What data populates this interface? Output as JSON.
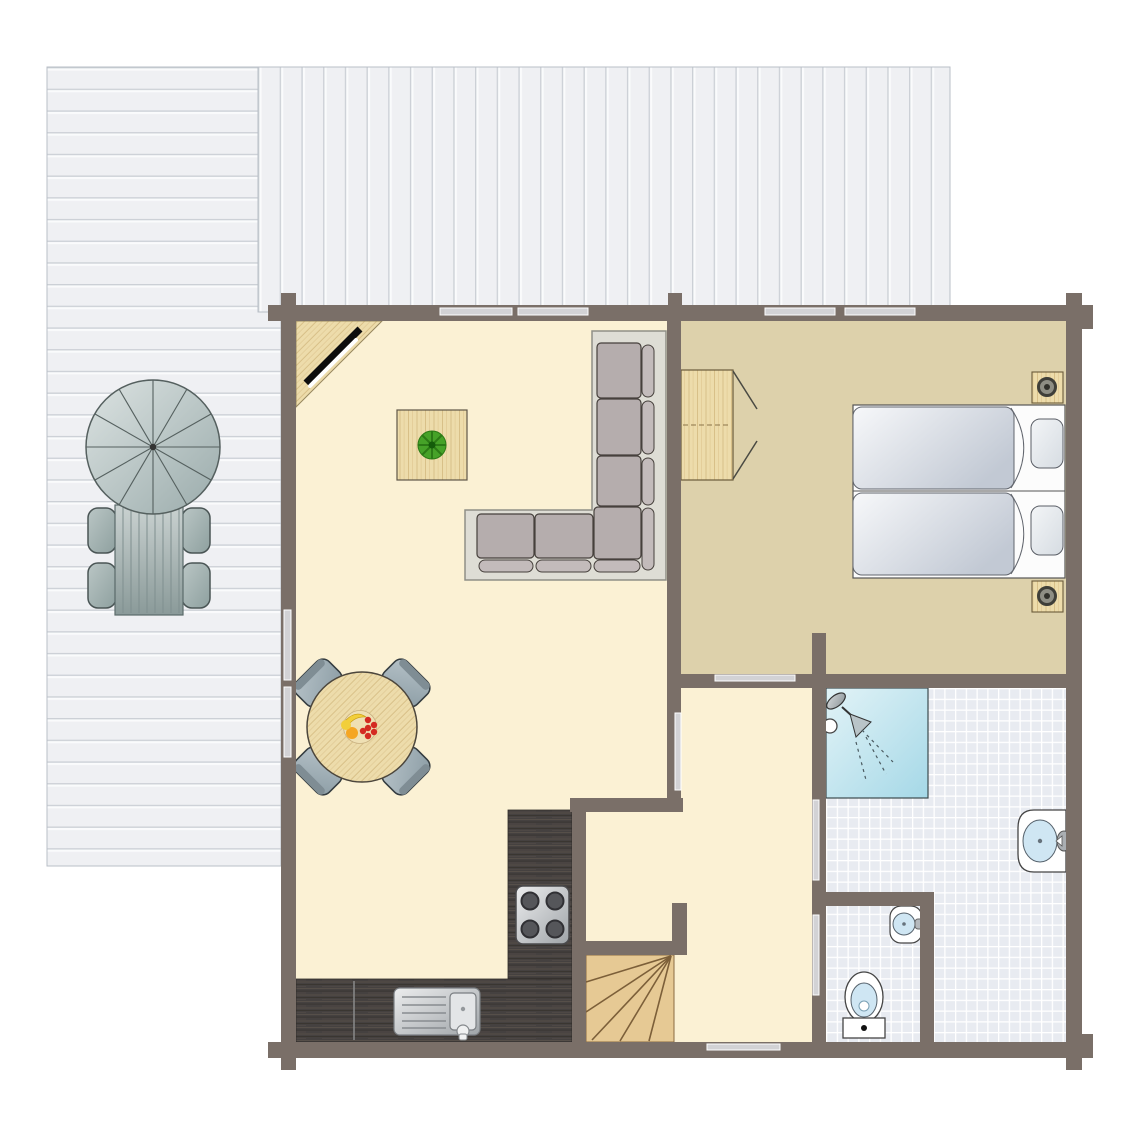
{
  "plan": {
    "kind": "holiday-home-floor-plan",
    "areas": [
      "terrace-side",
      "terrace-top",
      "living-dining-kitchen",
      "bedroom",
      "hallway",
      "bathroom",
      "toilet-room",
      "staircase"
    ],
    "furniture": {
      "terrace": [
        "parasol",
        "outdoor-table",
        "outdoor-chair",
        "outdoor-chair",
        "outdoor-chair",
        "outdoor-chair"
      ],
      "living": [
        "corner-tv",
        "coffee-table",
        "potted-plant",
        "corner-sofa",
        "dining-table",
        "dining-chair",
        "dining-chair",
        "dining-chair",
        "dining-chair",
        "fruit-bowl"
      ],
      "kitchen": [
        "counter",
        "stove",
        "sink"
      ],
      "bedroom": [
        "wardrobe",
        "twin-bed",
        "twin-bed",
        "nightstand",
        "nightstand",
        "lamp",
        "lamp"
      ],
      "bathroom": [
        "shower",
        "washbasin"
      ],
      "toilet_room": [
        "washbasin",
        "toilet"
      ],
      "stairs": [
        "staircase"
      ]
    },
    "openings": {
      "windows_top_wall": 4,
      "windows_west_wall": 2,
      "interior_doors": 4,
      "entrance_door": 1
    }
  },
  "colors": {
    "wall": "#7a6f68",
    "floor_living": "#fbf1d4",
    "floor_bedroom": "#ddd1ab",
    "tile": "#e8ebf1",
    "tile_line": "#ffffff",
    "deck": "#eff0f3",
    "deck_line": "#ccd0d6",
    "deck_highlight": "#fafbfc",
    "door_bar": "#d2d2d5",
    "wood": "#eddcab",
    "wood_grain": "#d8c088",
    "counter": "#454140",
    "counter_streak_light": "#564f49",
    "counter_streak_dark": "#38342f",
    "stairs": "#e6c994",
    "stairs_line": "#7c5f39",
    "shower_start": "#e2f3f7",
    "shower_end": "#a5d8e7",
    "sofa_base": "#deddd5",
    "sofa_cushion": "#b5adad",
    "sofa_bolster": "#c3bbbb",
    "steel_light": "#ecedee",
    "steel_dark": "#9fa4a8",
    "fixture_bowl": "#cfe6f3",
    "duvet_light": "#f7f8fa",
    "duvet_dark": "#c2c9d4",
    "pillow_light": "#f3f5f7",
    "pillow_dark": "#d6dce2",
    "parasol_light": "#dce3e2",
    "parasol_dark": "#9aabab",
    "outtable_light": "#cad2d1",
    "outtable_dark": "#8a9a99",
    "outchair_light": "#bac6c5",
    "outchair_dark": "#8ea09f",
    "dinchair_light": "#b6c2c8",
    "dinchair_dark": "#8c9da5",
    "plant_green": "#46a228",
    "plant_dark": "#2c7a16",
    "fruit_red": "#d42a22",
    "fruit_orange": "#f5a623",
    "fruit_yellow": "#f2cf3a",
    "tv_black": "#0d0d0d",
    "white": "#ffffff"
  }
}
